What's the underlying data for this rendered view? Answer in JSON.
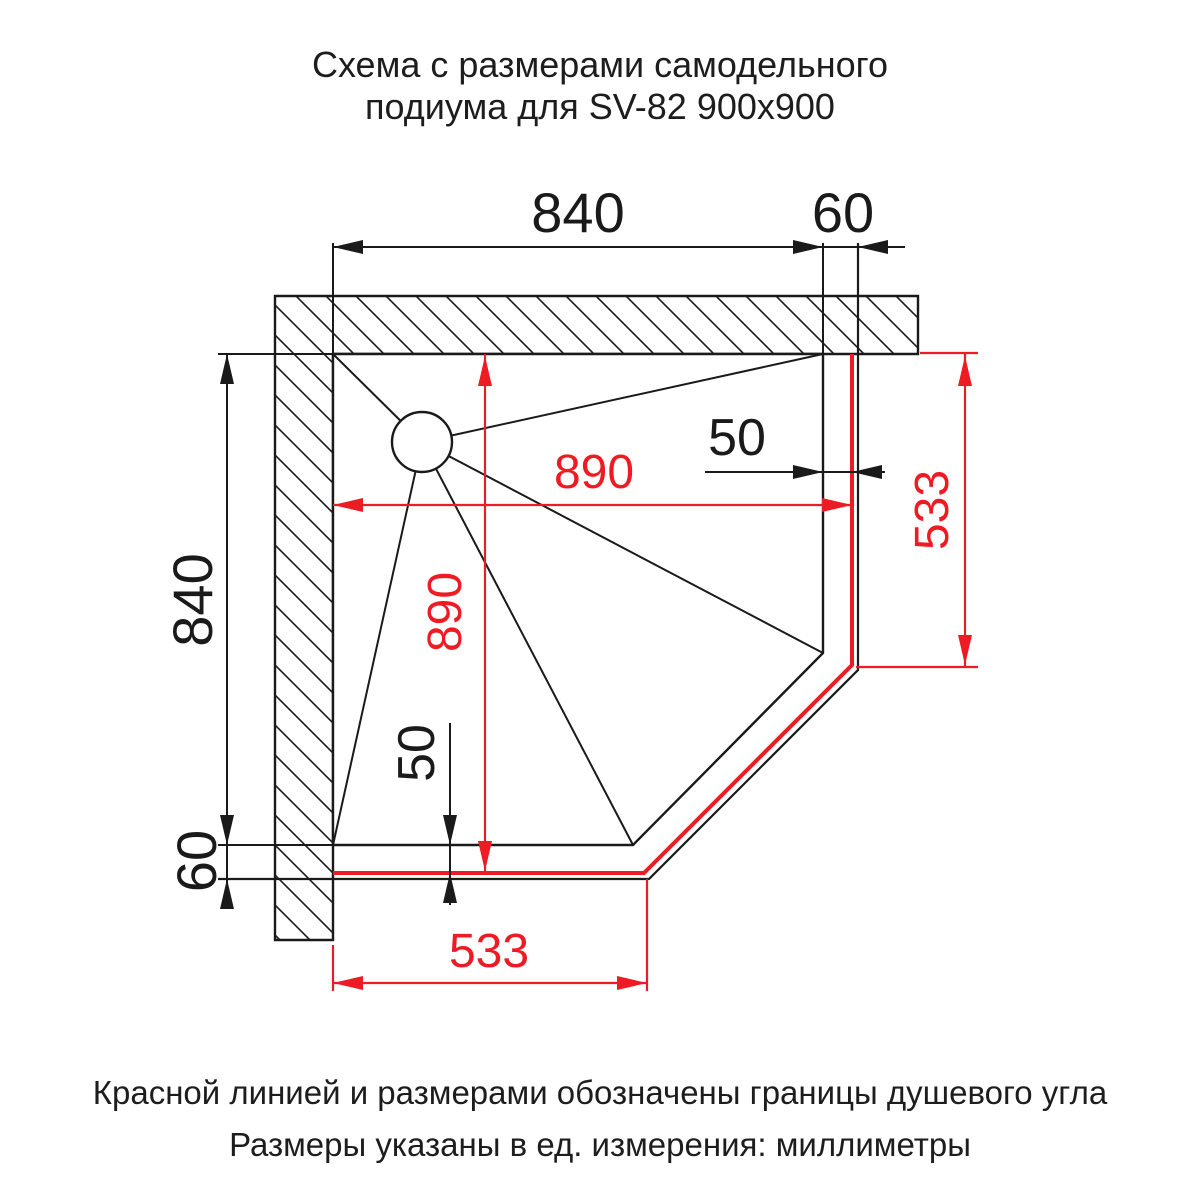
{
  "title": {
    "line1": "Схема с размерами самодельного",
    "line2": "подиума для SV-82 900x900"
  },
  "diagram": {
    "dims_black": {
      "top_width": "840",
      "top_offset": "60",
      "left_height": "840",
      "left_offset": "60",
      "right_gap": "50",
      "bottom_gap": "50"
    },
    "dims_red": {
      "shower_width": "890",
      "shower_height": "890",
      "right_edge": "533",
      "bottom_edge": "533"
    }
  },
  "footer": {
    "line1": "Красной линией и размерами обозначены границы душевого угла",
    "line2": "Размеры указаны в ед. измерения: миллиметры"
  },
  "colors": {
    "red_accent": "#ed1c24",
    "line_black": "#1a1a1a",
    "background": "#ffffff"
  }
}
